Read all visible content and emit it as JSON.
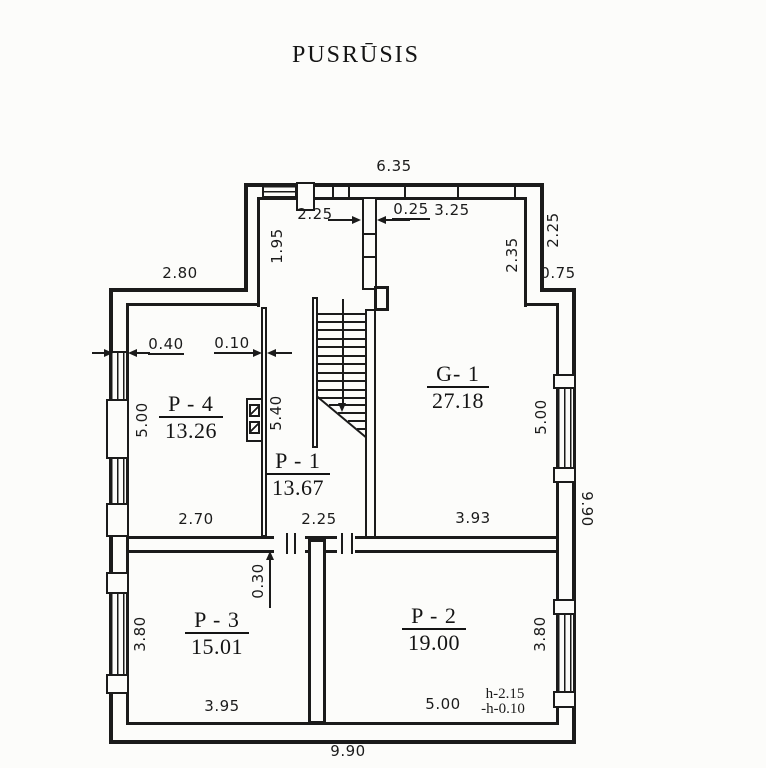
{
  "title": "PUSRŪSIS",
  "plan_type": "floor-plan",
  "rooms": [
    {
      "label": "P - 1",
      "area": "13.67"
    },
    {
      "label": "P - 2",
      "area": "19.00"
    },
    {
      "label": "P - 3",
      "area": "15.01"
    },
    {
      "label": "P - 4",
      "area": "13.26"
    },
    {
      "label": "G- 1",
      "area": "27.18"
    }
  ],
  "dims": {
    "overall_top": "6.35",
    "top_left_span": "2.25",
    "partition_thickness": "0.25",
    "g1_top_span": "3.25",
    "hall_upper_depth": "1.95",
    "g1_right_upper": "2.35",
    "right_upper_span": "2.25",
    "right_step": "0.75",
    "p4_top_span": "2.80",
    "left_wall_thickness": "0.40",
    "hall_wall_thickness": "0.10",
    "p4_left_span": "5.00",
    "hall_length": "5.40",
    "p4_bottom_span": "2.70",
    "hall_bottom_span": "2.25",
    "g1_bottom_span": "3.93",
    "g1_right_span": "5.00",
    "right_overall": "9.90",
    "door_offset": "0.30",
    "p3_left_span": "3.80",
    "p2_right_span": "3.80",
    "p3_bottom_span": "3.95",
    "p2_bottom_span": "5.00",
    "bottom_overall": "9.90",
    "height_note_line1": "h-2.15",
    "height_note_line2": "-h-0.10"
  },
  "colors": {
    "ink": "#1b1b1b",
    "paper": "#fcfcfa"
  }
}
